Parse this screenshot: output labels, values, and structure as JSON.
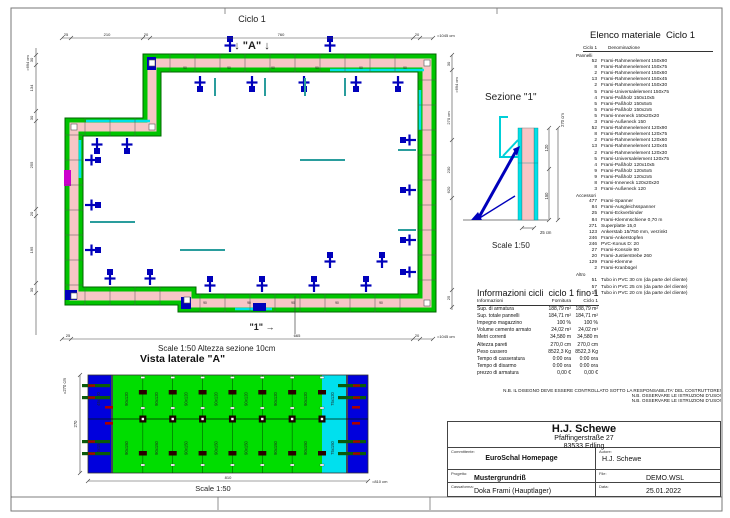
{
  "plan": {
    "title": "Ciclo 1",
    "marker_a": "↓ \"A\" ↓",
    "marker_1": "\"1\" →",
    "panel_width_label": "90",
    "scale_note": "Scale 1:50   Altezza sezione 10cm",
    "dim_top": {
      "segs": [
        "25",
        "210",
        "20",
        "760",
        "20"
      ],
      "total": "=1045 cm"
    },
    "dim_left": {
      "segs": [
        "30",
        "134",
        "30",
        "255",
        "20",
        "195",
        "30"
      ],
      "total": "=694 cm"
    },
    "dim_right": {
      "segs": [
        "30",
        "270 cm",
        "230",
        "620",
        "25"
      ],
      "total": "=694 cm"
    },
    "dim_bottom": {
      "segs": [
        "25",
        "665",
        "20"
      ],
      "total": "=1045 cm"
    }
  },
  "sezione": {
    "title": "Sezione \"1\"",
    "scale": "Scale 1:50",
    "dim_total": "270 cm",
    "dim_upper": "120",
    "dim_lower": "150",
    "dim_thickness": "25 cm"
  },
  "vista": {
    "heading": "Vista laterale \"A\"",
    "scale": "Scale 1:50",
    "dim_total": "810",
    "dim_total_label": "=810 cm",
    "dim_height_total": "=270 cm",
    "dim_height": "270",
    "green_top_label": "90x120",
    "green_bottom_label": "90x150",
    "cyan_top_label": "75x120",
    "cyan_bottom_label": "75x150",
    "blue_top_label": "45x120",
    "blue_bottom_label": "45x150",
    "green_count": 7
  },
  "materials": {
    "title": "Elenco materiale  Ciclo 1",
    "col1": "Ciclo 1",
    "col2": "Denominazione",
    "groups": [
      {
        "name": "Pannelli",
        "items": [
          {
            "qty": "52",
            "name": "Frami-Rahmenelement 150x90"
          },
          {
            "qty": "8",
            "name": "Frami-Rahmenelement 150x75"
          },
          {
            "qty": "2",
            "name": "Frami-Rahmenelement 150x60"
          },
          {
            "qty": "13",
            "name": "Frami-Rahmenelement 150x45"
          },
          {
            "qty": "2",
            "name": "Frami-Rahmenelement 150x30"
          },
          {
            "qty": "5",
            "name": "Frami-Universalelement 150x75"
          },
          {
            "qty": "4",
            "name": "Frami-Paßholz 150x10x5"
          },
          {
            "qty": "5",
            "name": "Frami-Paßholz 150x5x5"
          },
          {
            "qty": "5",
            "name": "Frami-Paßholz 150x2x5"
          },
          {
            "qty": "5",
            "name": "Frami-Inneneck 150x20x20"
          },
          {
            "qty": "3",
            "name": "Frami-Außeneck 150"
          },
          {
            "qty": "52",
            "name": "Frami-Rahmenelement 120x90"
          },
          {
            "qty": "8",
            "name": "Frami-Rahmenelement 120x75"
          },
          {
            "qty": "2",
            "name": "Frami-Rahmenelement 120x60"
          },
          {
            "qty": "13",
            "name": "Frami-Rahmenelement 120x45"
          },
          {
            "qty": "2",
            "name": "Frami-Rahmenelement 120x30"
          },
          {
            "qty": "5",
            "name": "Frami-Universalelement 120x75"
          },
          {
            "qty": "4",
            "name": "Frami-Paßholz 120x10x5"
          },
          {
            "qty": "9",
            "name": "Frami-Paßholz 120x5x5"
          },
          {
            "qty": "9",
            "name": "Frami-Paßholz 120x2x5"
          },
          {
            "qty": "8",
            "name": "Frami-Inneneck 120x20x20"
          },
          {
            "qty": "3",
            "name": "Frami-Außeneck 120"
          }
        ]
      },
      {
        "name": "Accessori",
        "items": [
          {
            "qty": "477",
            "name": "Frami-Spanner"
          },
          {
            "qty": "84",
            "name": "Frami-Ausgleichsspanner"
          },
          {
            "qty": "25",
            "name": "Frami-Eckverbinder"
          },
          {
            "qty": "84",
            "name": "Frami-Klemmschiene 0,70 m"
          },
          {
            "qty": "271",
            "name": "Superplatte 15,0"
          },
          {
            "qty": "123",
            "name": "Ankerstab 15/750 mm, verzinkt"
          },
          {
            "qty": "246",
            "name": "Frami-Ankerstopfen"
          },
          {
            "qty": "246",
            "name": "PVC-Konus D: 20"
          },
          {
            "qty": "27",
            "name": "Frami-Konsole 90"
          },
          {
            "qty": "20",
            "name": "Frami-Justierstrebe 260"
          },
          {
            "qty": "129",
            "name": "Frami-Klemme"
          },
          {
            "qty": "2",
            "name": "Frami-Kranbügel"
          }
        ]
      },
      {
        "name": "Altro",
        "items": [
          {
            "qty": "51",
            "name": "Tubo in PVC 30 cm (da parte del cliente)"
          },
          {
            "qty": "57",
            "name": "Tubo in PVC 25 cm (da parte del cliente)"
          },
          {
            "qty": "15",
            "name": "Tubo in PVC 20 cm (da parte del cliente)"
          }
        ]
      }
    ]
  },
  "cycle_info": {
    "title": "Informazioni cicli  ciclo 1 fino 1",
    "headers": [
      "Informazioni",
      "Fornitura",
      "Ciclo 1"
    ],
    "rows": [
      [
        "Sup. di armatura",
        "188,79 m²",
        "188,79 m²"
      ],
      [
        "Sup. totale pannelli",
        "184,71 m²",
        "184,71 m²"
      ],
      [
        "Impegno magazzino",
        "100 %",
        "100 %"
      ],
      [
        "Volume cemento armato",
        "24,02 m³",
        "24,02 m³"
      ],
      [
        "Metri correnti",
        "34,580 m",
        "34,580 m"
      ],
      [
        "Altezza pareti",
        "270,0 cm",
        "270,0 cm"
      ],
      [
        "Peso cassero",
        "8522,3 Kg",
        "8522,3 Kg"
      ],
      [
        "Tempo di casseratura",
        "0:00 ora",
        "0:00 ora"
      ],
      [
        "Tempo di disarmo",
        "0:00 ora",
        "0:00 ora"
      ],
      [
        "prezzo di armatura",
        "0,00 €",
        "0,00 €"
      ]
    ]
  },
  "notes": [
    "N.B. IL DISEGNO DEVE ESSERE CONTROLLATO SOTTO LA RESPONSABILITA' DEL COSTRUTTORE!",
    "N.B. OSSERVARE LE ISTRUZIONI D'USO!",
    "N.B. OSSERVARE LE ISTRUZIONI D'USO!"
  ],
  "title_block": {
    "company": "H.J. Schewe",
    "address1": "Pfaffingerstraße 27",
    "address2": "83533 Edling",
    "client_label": "Committente:",
    "client": "EuroSchal Homepage",
    "author_label": "Autore:",
    "author": "H.J. Schewe",
    "project_label": "Progetto:",
    "project": "Mustergrundriß",
    "file_label": "File:",
    "file": "DEMO.WSL",
    "formwork_label": "Cassaforma:",
    "formwork": "Doka Frami (Hauptlager)",
    "date_label": "Data:",
    "date": "25.01.2022"
  },
  "colors": {
    "wall_fill": "#f7c6c6",
    "panel_green": "#00c400",
    "panel_green_dark": "#007a00",
    "panel_cyan": "#00e0e8",
    "tie_blue": "#0000bb",
    "brace_teal": "#2a9d9d",
    "magenta": "#cc00cc",
    "elev_green": "#00dd00",
    "elev_blue": "#0000dd",
    "elev_cyan": "#00e0ee",
    "clamp_red": "#aa0000"
  }
}
